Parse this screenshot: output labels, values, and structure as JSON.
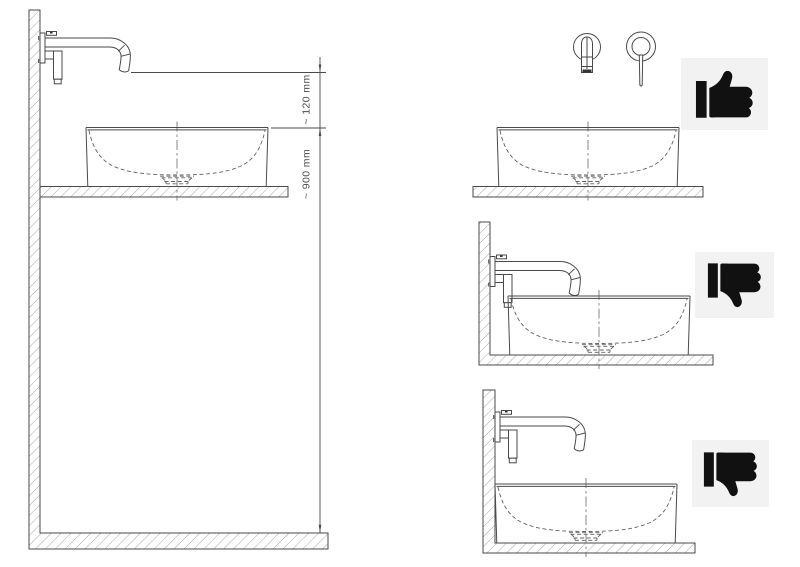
{
  "diagram": {
    "subject": "wall-mounted basin mixer installation over countertop vessel basin",
    "view": "side-section line drawing with dimensioned reference and three mounting variants"
  },
  "labels": {
    "spout_clearance": "~ 120 mm",
    "rim_height": "~ 900 mm"
  },
  "panels": [
    {
      "id": "main-dimension-view",
      "verdict": ""
    },
    {
      "id": "correct-mounting-height",
      "verdict": "approved",
      "icon": "thumbs-up"
    },
    {
      "id": "spout-too-low",
      "verdict": "rejected",
      "icon": "thumbs-down"
    },
    {
      "id": "insufficient-clearance",
      "verdict": "rejected",
      "icon": "thumbs-down"
    }
  ],
  "colors": {
    "background": "#ffffff",
    "line": "#4a4a4a",
    "hatch": "#8f8f8f",
    "dimension_text": "#4d4d4d",
    "icon_background": "#f2f2f2",
    "icon_glyph": "#111111"
  }
}
